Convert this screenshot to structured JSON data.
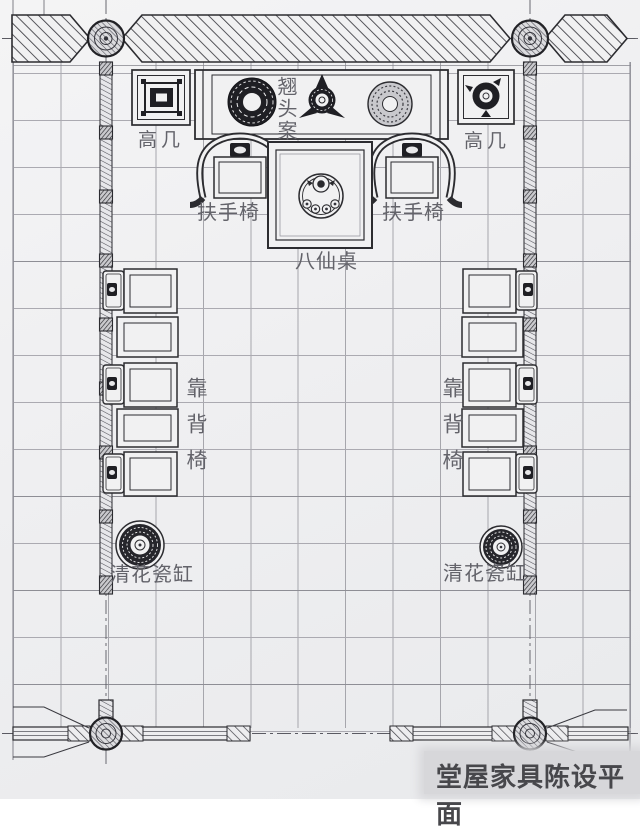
{
  "drawing": {
    "title": "堂屋家具陈设平面",
    "labels": {
      "tall_stand_left": "高几",
      "tall_stand_right": "高几",
      "altar_table": "翘头案",
      "armchair_left": "扶手椅",
      "armchair_right": "扶手椅",
      "eight_immortals_table": "八仙桌",
      "back_chairs_left": "靠背椅",
      "back_chairs_right": "靠背椅",
      "porcelain_vat_left": "清花瓷缸",
      "porcelain_vat_right": "清花瓷缸"
    },
    "colors": {
      "paper": "#f1f1f2",
      "ink": "#2c2c30",
      "grid_line": "#a6a6ac",
      "label_text": "#63636a",
      "title_text": "#47474b",
      "dark_fill": "#1f1f24",
      "title_band": "#d7d7da"
    }
  }
}
